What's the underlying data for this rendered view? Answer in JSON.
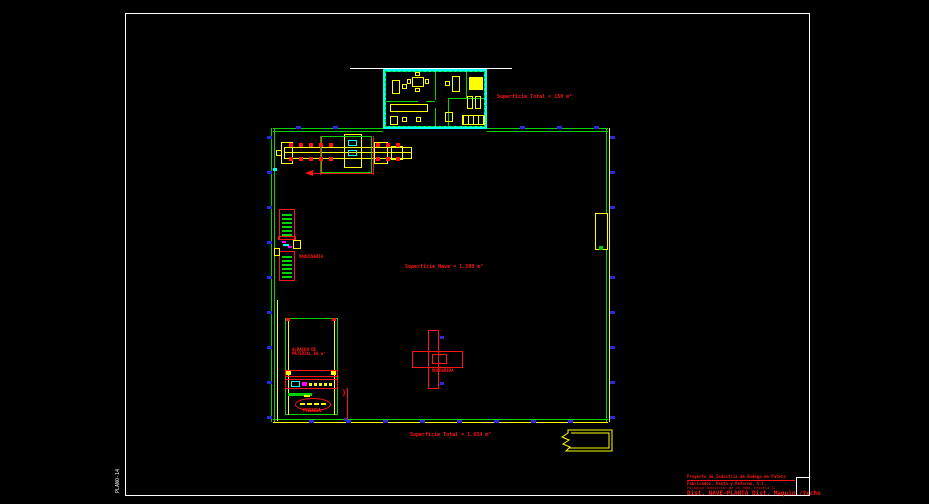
{
  "colors": {
    "background": "#000000",
    "wall_green": "#00d400",
    "office_cyan": "#00ffff",
    "machine_yellow": "#ffff00",
    "annotation_red": "#ff1414",
    "column_blue": "#2a2ad8",
    "detail_magenta": "#ff00ff",
    "frame_white": "#ffffff"
  },
  "frame": {
    "side_label": "PLANO-14"
  },
  "labels": {
    "office_area": "Superficie Total = 150 m²",
    "nave_area": "Superficie Nave = 1.500 m²",
    "total_area": "Superficie Total = 1.654 m²",
    "machine": "MAQUINARIA",
    "moldurera": "MOLDURERA",
    "store_line1": "ALMACEN DE",
    "store_line2": "MATERIAL 60 m²",
    "press": "PRENSA",
    "detail_mark": "}"
  },
  "title_block": {
    "line1": "Proyecto de Industria de Bodega de Palets",
    "line2": "Fabricados, Venta y Reforma, S.L.",
    "line3": "Poligono Industrial de la Vega, Parcela 12",
    "line4": "Dist. NAVE-PLANTA  Dist. Maquin./techo"
  }
}
